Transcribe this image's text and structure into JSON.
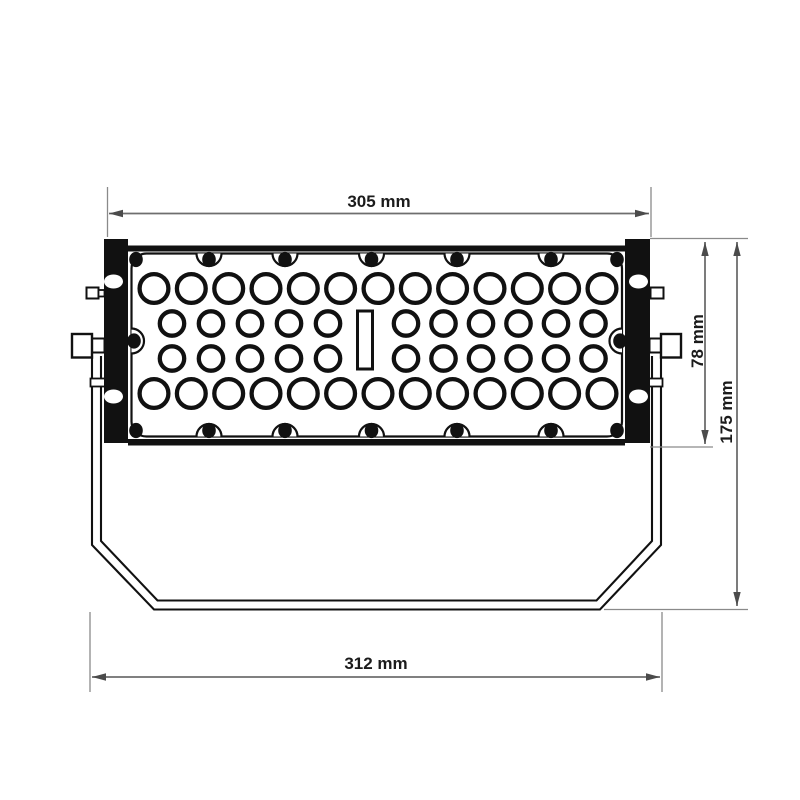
{
  "page": {
    "background": "#ffffff"
  },
  "drawing": {
    "subject": "floodlight-front-view-technical-drawing",
    "colors": {
      "outline": "#111111",
      "paper": "#ffffff",
      "dimension_line": "#6e6e6e",
      "extension_line": "#8a8a8a",
      "arrow": "#4b4b4b",
      "label_text": "#1b1b1b"
    },
    "dimensions": {
      "top_width": {
        "label": "305 mm",
        "value_mm": 305,
        "orientation": "horizontal"
      },
      "body_height": {
        "label": "78 mm",
        "value_mm": 78,
        "orientation": "vertical"
      },
      "total_height": {
        "label": "175 mm",
        "value_mm": 175,
        "orientation": "vertical"
      },
      "bottom_width": {
        "label": "312 mm",
        "value_mm": 312,
        "orientation": "horizontal"
      }
    },
    "perforations": {
      "row_count": 4,
      "outer_row_circle_count": 13,
      "inner_row_left_count": 5,
      "inner_row_right_count": 6,
      "center_slot": true
    },
    "screws": {
      "top_edge": 7,
      "bottom_edge": 7,
      "left_edge": 1,
      "right_edge": 1
    },
    "bracket_holes_per_side": 2
  }
}
